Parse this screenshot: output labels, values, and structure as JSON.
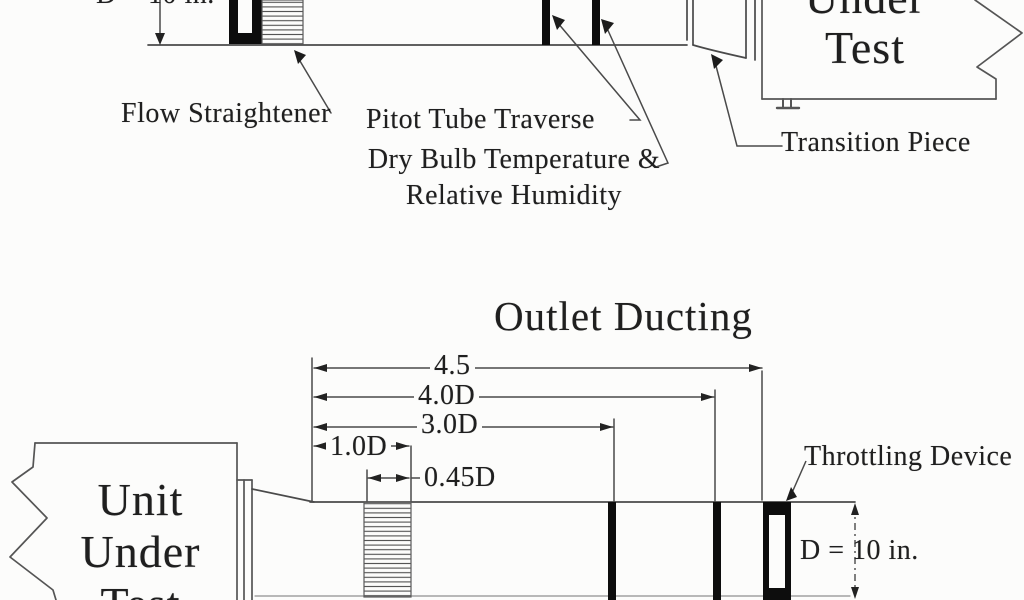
{
  "colors": {
    "background": "#fcfcfb",
    "ink": "#1f1f1f",
    "line": "#4a4a4a",
    "device_fill": "#0d0d0d"
  },
  "inlet": {
    "dim_label": "D = 10 in.",
    "flow_straightener_label": "Flow Straightener",
    "pitot_label": "Pitot Tube Traverse",
    "dry_bulb_label_line1": "Dry Bulb Temperature &",
    "dry_bulb_label_line2": "Relative Humidity",
    "transition_label": "Transition Piece",
    "unit_box_line1": "Under",
    "unit_box_line2": "Test"
  },
  "outlet": {
    "title": "Outlet Ducting",
    "dim_4_5": "4.5",
    "dim_4_0d": "4.0D",
    "dim_3_0d": "3.0D",
    "dim_1_0d": "1.0D",
    "dim_0_45d": "0.45D",
    "throttling_label": "Throttling Device",
    "dim_label": "D = 10 in.",
    "unit_box_line1": "Unit",
    "unit_box_line2": "Under",
    "unit_box_line3": "Test"
  }
}
